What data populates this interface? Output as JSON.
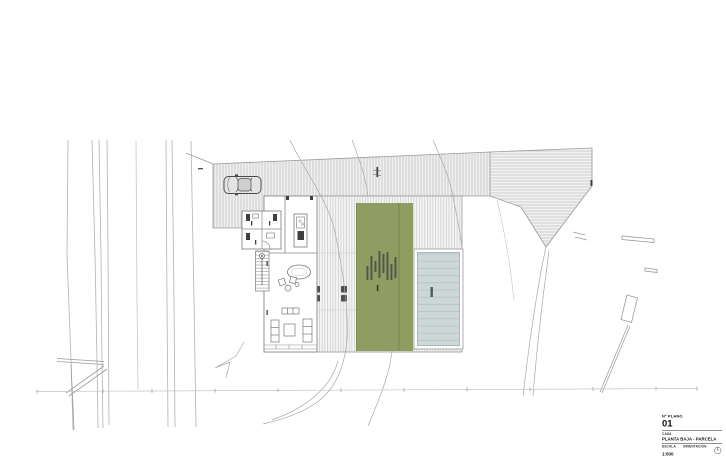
{
  "title_block": {
    "plan_number_label": "Nº PLANO",
    "plan_number": "01",
    "project_label": "CASA",
    "plan_title": "PLANTA BAJA - PARCELA",
    "scale_label": "ESCALA",
    "scale_value": "1:500",
    "orientation_label": "ORIENTACIÓN"
  },
  "drawing_colors": {
    "paper": "#FFFFFF",
    "garden_green": "#8F9D63",
    "garden_green_dark": "#77864E",
    "pool_water": "#CDD7D8",
    "pool_lines": "#AEBEC1",
    "hatch_fill": "#EFEFEF",
    "hatch_stripe": "#C5C5C5",
    "line_work": "#9A9A9A",
    "dark_detail": "#3F3F3F"
  }
}
